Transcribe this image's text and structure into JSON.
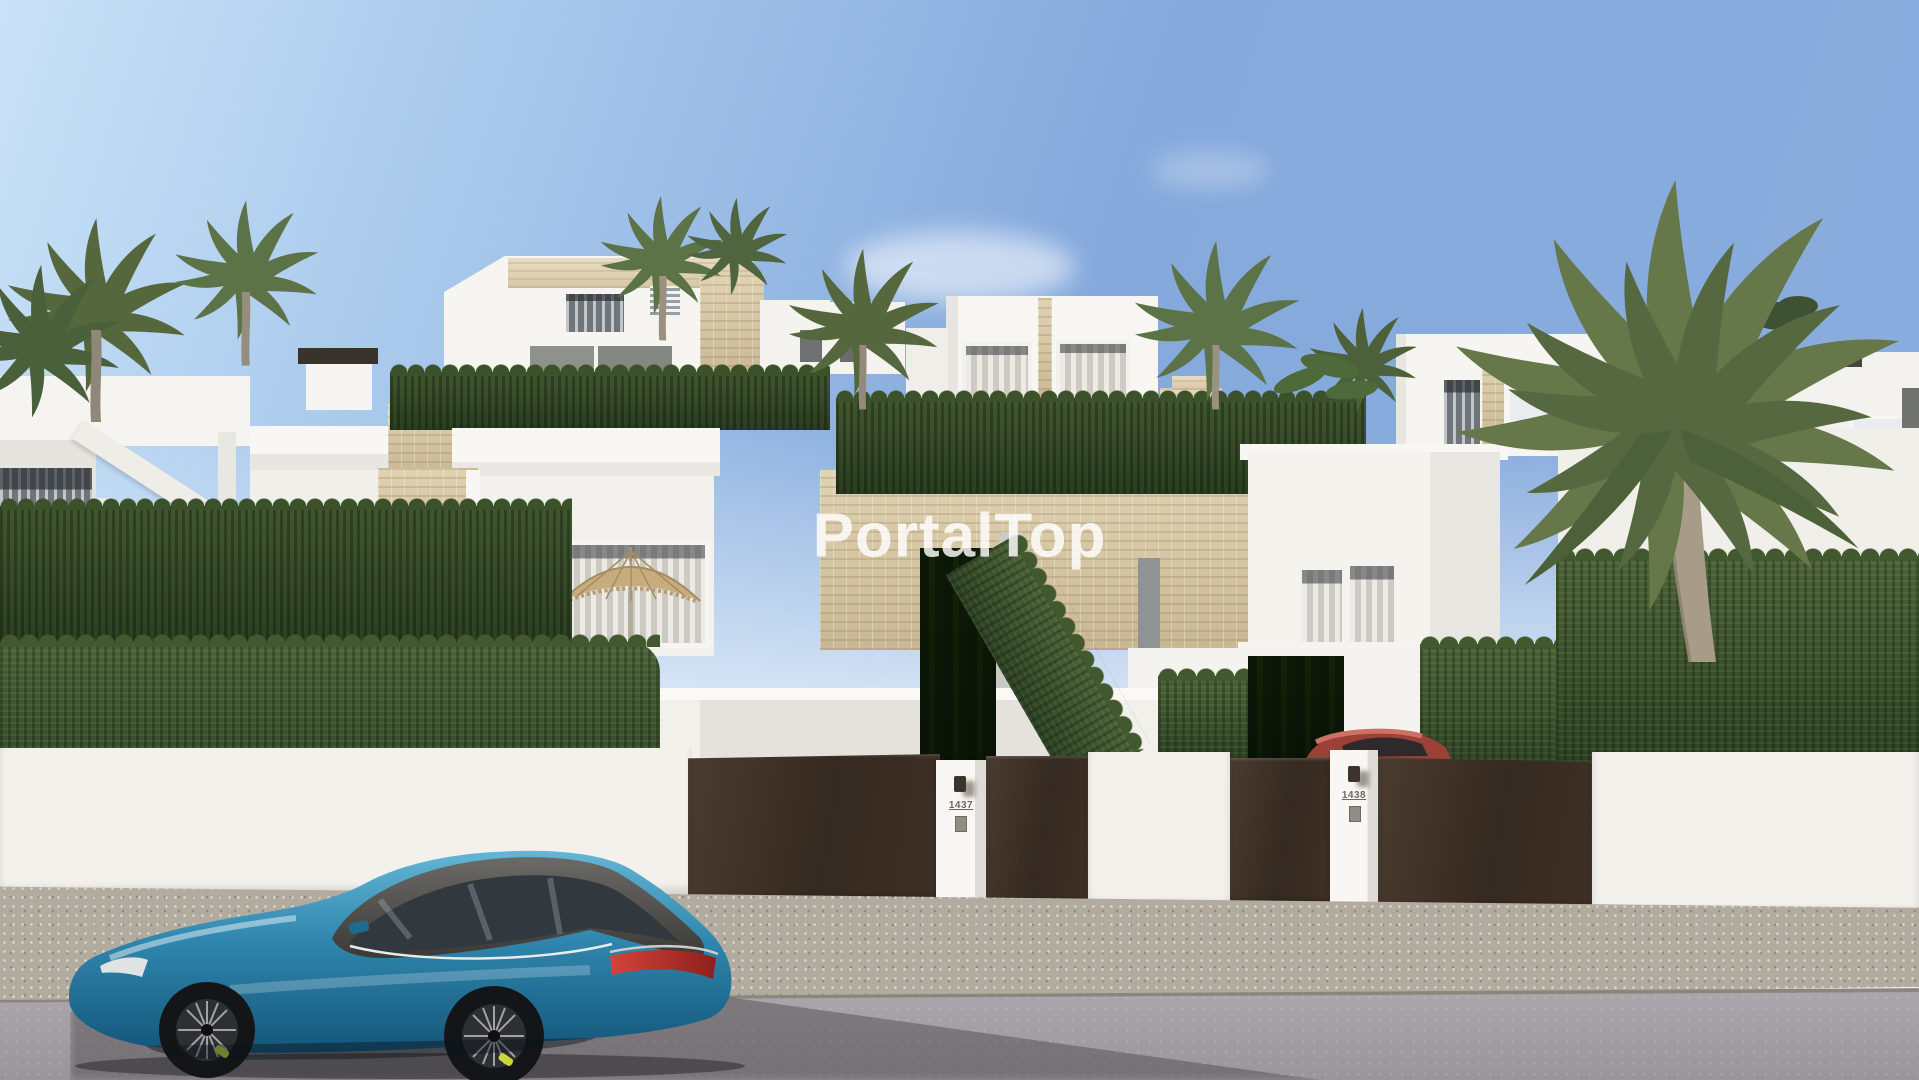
{
  "watermark": {
    "text": "PortalTop"
  },
  "street": {
    "pillars": [
      {
        "number": "1437"
      },
      {
        "number": "1438"
      }
    ]
  },
  "objects": {
    "vehicles": [
      {
        "name": "blue-estate-car",
        "color": "#2f86ad"
      },
      {
        "name": "red-parked-car",
        "color": "#9c4038"
      }
    ]
  },
  "palette": {
    "sky_top": "#85a9dc",
    "sky_horizon": "#eef5fb",
    "wall_white": "#f3f1ec",
    "stone_beige": "#d6c7a4",
    "hedge_green": "#3a512c",
    "gate_brown": "#352a21",
    "sidewalk": "#b2aba0",
    "road": "#a09ba0",
    "car_roof_graphite": "#4c4b48",
    "taillight_red": "#b92f27",
    "brake_caliper_yellow": "#c9d63c"
  }
}
